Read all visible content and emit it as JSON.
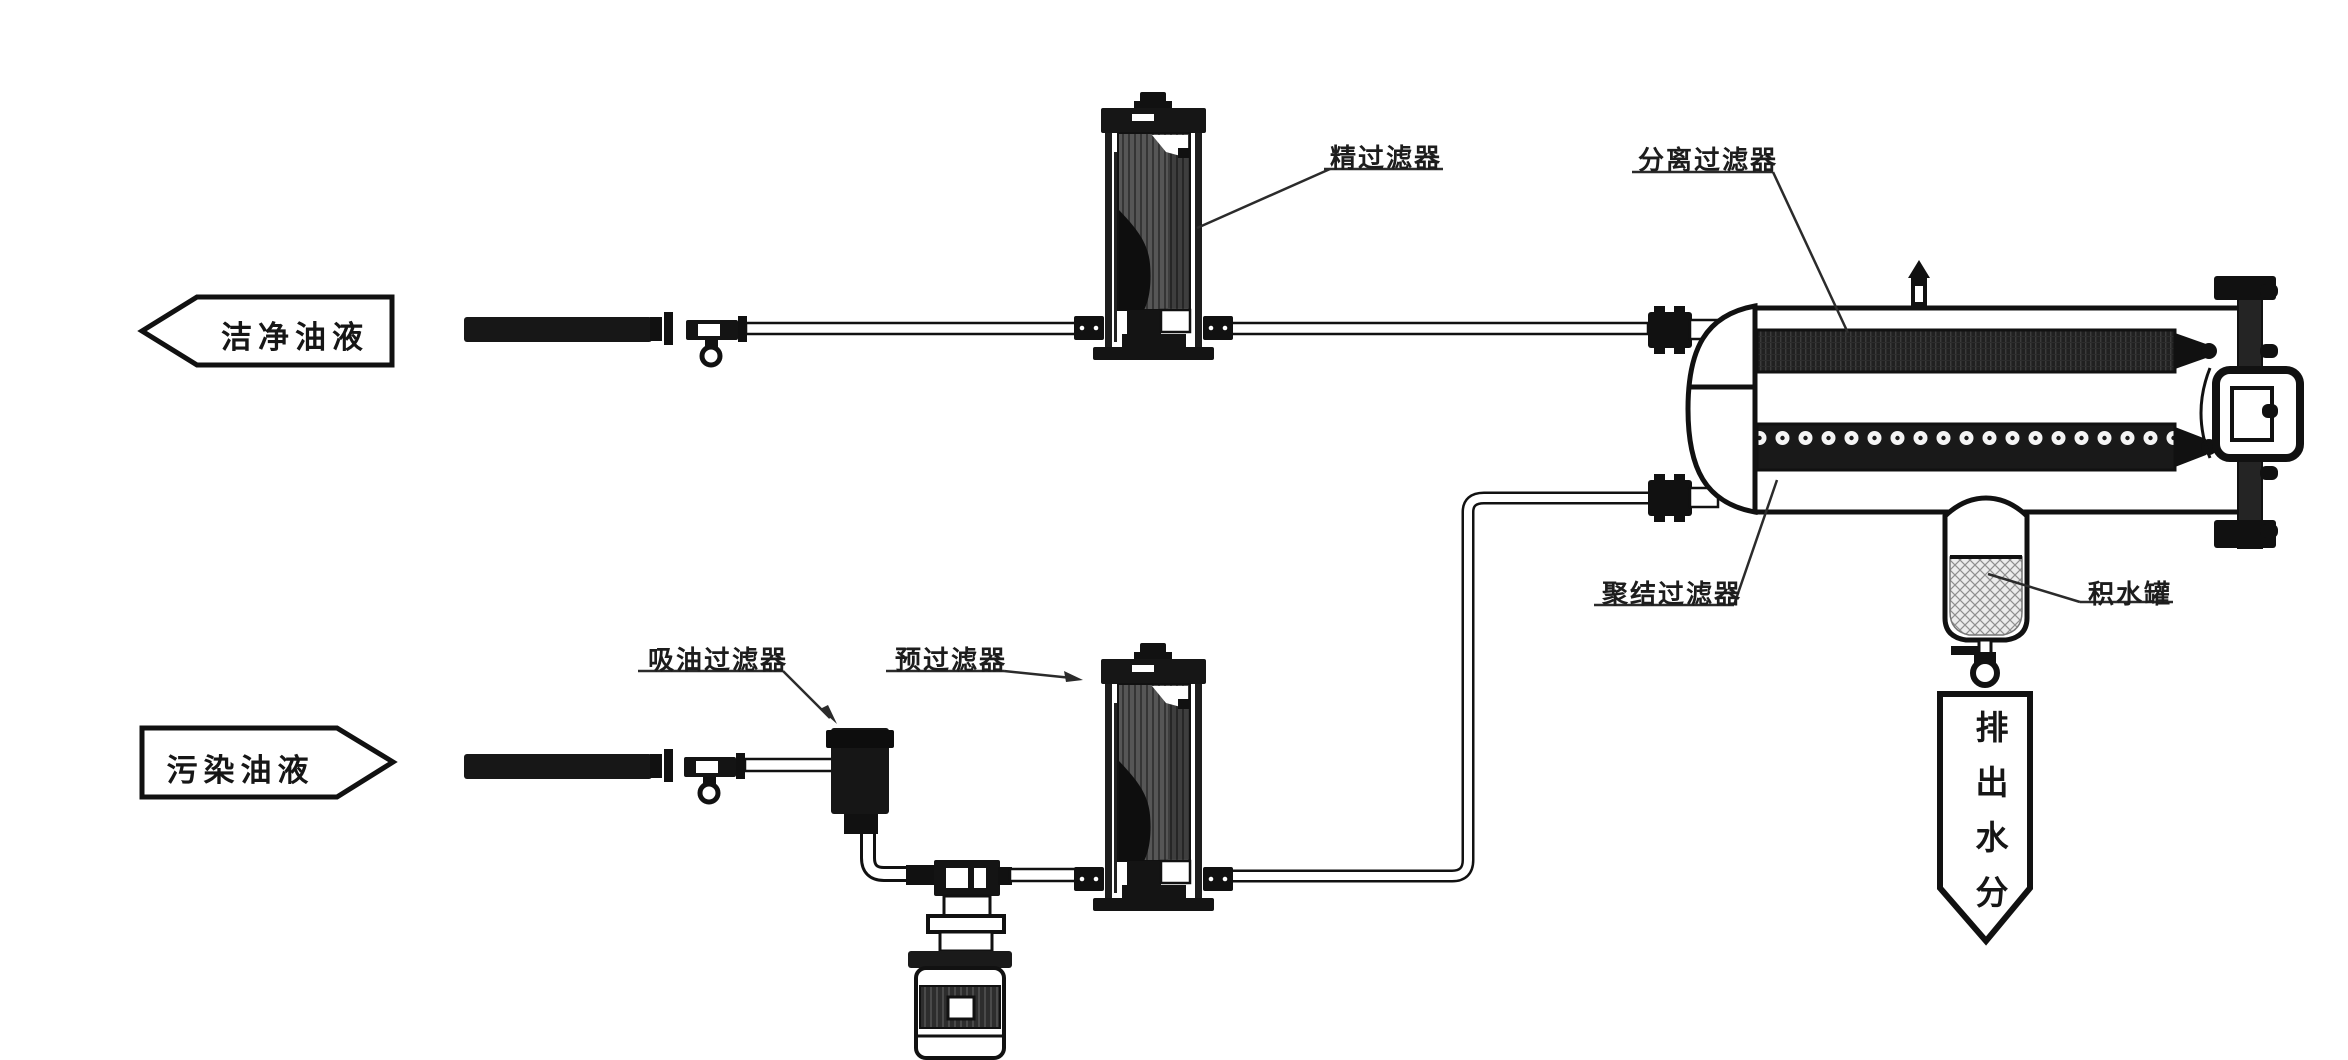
{
  "diagram": {
    "flow_banners": {
      "clean_oil": "洁净油液",
      "dirty_oil": "污染油液",
      "water_out": "排出水分"
    },
    "component_labels": {
      "fine_filter": "精过滤器",
      "separation_filter": "分离过滤器",
      "suction_filter": "吸油过滤器",
      "pre_filter": "预过滤器",
      "coalescing_filter": "聚结过滤器",
      "water_tank": "积水罐"
    },
    "colors": {
      "line": "#1a1a1a",
      "dark_fill": "#161616",
      "background": "#ffffff"
    }
  }
}
